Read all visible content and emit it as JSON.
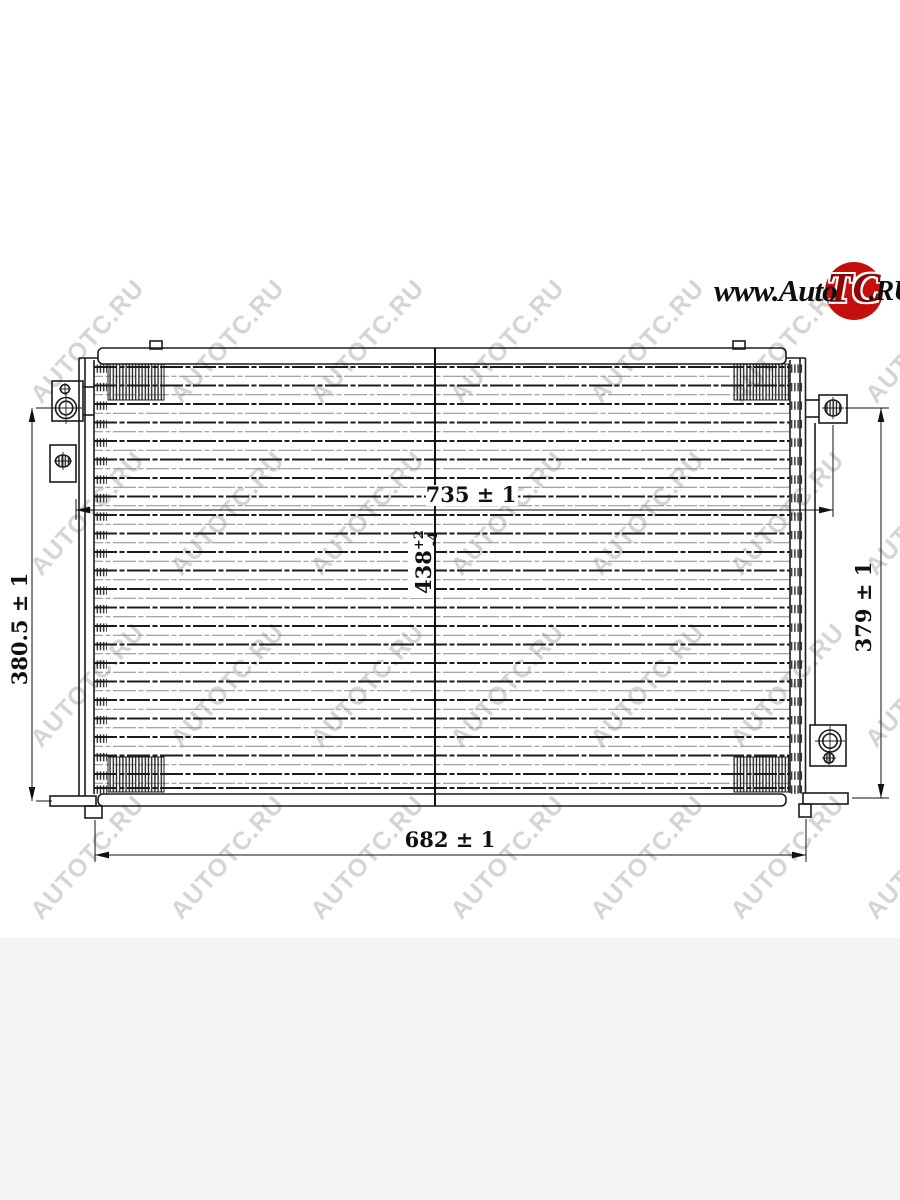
{
  "page": {
    "background": "#ffffff",
    "footer_background": "#f4f4f4"
  },
  "watermark": {
    "text": "AUTOTC.RU",
    "color": "rgba(105,105,105,0.28)"
  },
  "logo": {
    "prefix": "www.Auto",
    "emblem": "TC",
    "suffix": ".RU",
    "circle_color": "#c50f0f"
  },
  "drawing": {
    "type": "technical-line-drawing",
    "line_color": "#1c1c1c",
    "dimensions": {
      "upper_width": "735 ± 1",
      "center_height_value": "438",
      "center_height_tol_upper": "+2",
      "center_height_tol_lower": "-4",
      "left_height": "380.5 ± 1",
      "right_height": "379 ± 1",
      "bottom_width": "682 ± 1"
    }
  }
}
